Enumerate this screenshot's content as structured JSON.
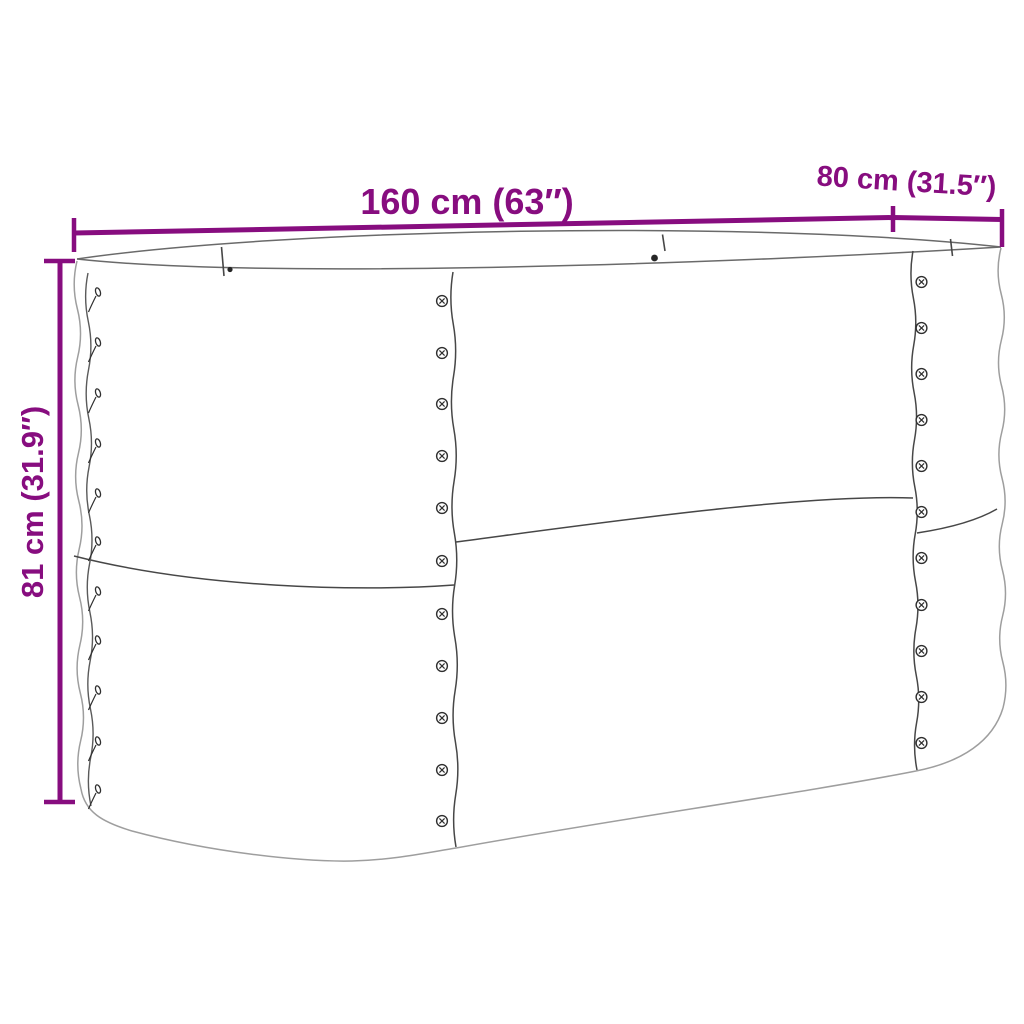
{
  "page": {
    "background": "#ffffff",
    "subject": "Line drawing of an oval corrugated raised garden bed with dimension annotations"
  },
  "colors": {
    "accent": "#870d7f",
    "outline_light": "#9e9e9e",
    "outline_dark": "#474747"
  },
  "dimensions": {
    "width": {
      "label": "160 cm (63″)"
    },
    "depth": {
      "label": "80 cm (31.5″)"
    },
    "height": {
      "label": "81 cm (31.9″)"
    }
  }
}
